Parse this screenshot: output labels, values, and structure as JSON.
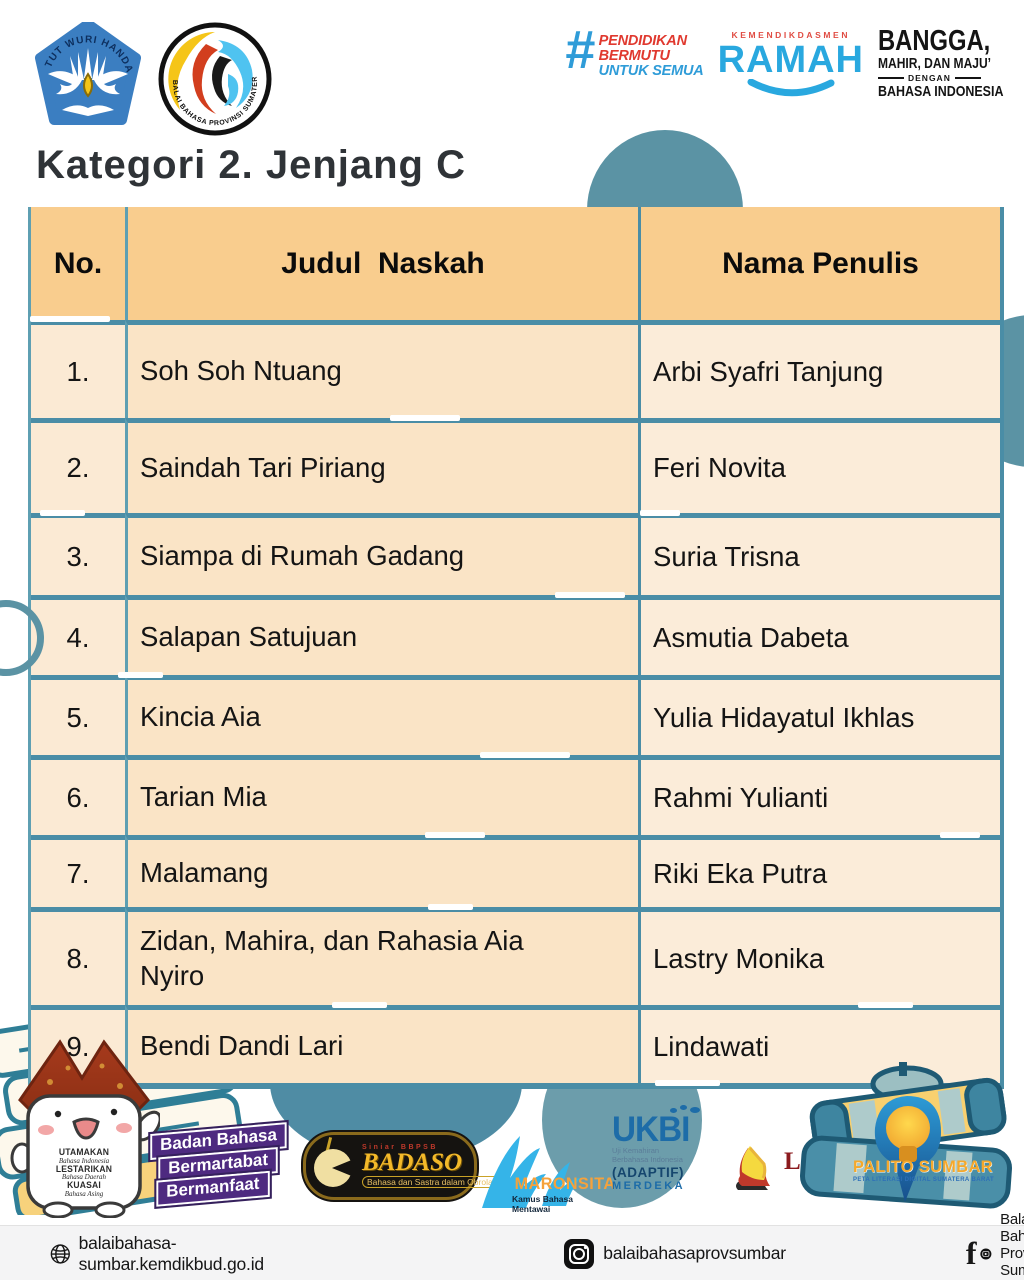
{
  "title": "Kategori 2. Jenjang C",
  "header": {
    "tut_wuri_arc": "TUT WURI HANDAYANI",
    "balai_arc": "BALAI BAHASA PROVINSI SUMATERA BARAT",
    "hashtag": "#",
    "pendidikan": "PENDIDIKAN",
    "bermutu": "BERMUTU",
    "untuk_semua": "UNTUK SEMUA",
    "kemendikdasmen": "KEMENDIKDASMEN",
    "ramah": "RAMAH",
    "bangga": "BANGGA,",
    "mahir": "MAHIR, DAN MAJU’",
    "dengan": "DENGAN",
    "bahasa_indonesia": "BAHASA INDONESIA"
  },
  "table": {
    "columns": {
      "no": "No.",
      "judul": "Judul  Naskah",
      "penulis": "Nama Penulis"
    },
    "rows": [
      {
        "no": "1.",
        "judul": "Soh Soh Ntuang",
        "penulis": "Arbi Syafri Tanjung"
      },
      {
        "no": "2.",
        "judul": "Saindah Tari Piriang",
        "penulis": "Feri Novita"
      },
      {
        "no": "3.",
        "judul": "Siampa di Rumah Gadang",
        "penulis": "Suria Trisna"
      },
      {
        "no": "4.",
        "judul": "Salapan Satujuan",
        "penulis": "Asmutia Dabeta"
      },
      {
        "no": "5.",
        "judul": "Kincia Aia",
        "penulis": "Yulia Hidayatul Ikhlas"
      },
      {
        "no": "6.",
        "judul": "Tarian Mia",
        "penulis": "Rahmi Yulianti"
      },
      {
        "no": "7.",
        "judul": "Malamang",
        "penulis": "Riki Eka Putra"
      },
      {
        "no": "8.",
        "judul": "Zidan, Mahira, dan Rahasia Aia Nyiro",
        "penulis": "Lastry Monika"
      },
      {
        "no": "9.",
        "judul": "Bendi Dandi Lari",
        "penulis": "Lindawati"
      }
    ]
  },
  "mascot": {
    "utamakan": "UTAMAKAN",
    "bahasa_indonesia": "Bahasa Indonesia",
    "lestarikan": "LESTARIKAN",
    "bahasa_daerah": "Bahasa Daerah",
    "kuasai": "KUASAI",
    "bahasa_asing": "Bahasa Asing"
  },
  "partners": {
    "badan_bahasa": {
      "line1": "Badan Bahasa",
      "line2": "Bermartabat",
      "line3": "Bermanfaat"
    },
    "badaso": {
      "siniar": "Siniar BBPSB",
      "name": "BADASO",
      "tagline": "Bahasa dan Sastra dalam Obrolan"
    },
    "maronsita": {
      "name": "MARONSITA",
      "tagline": "Kamus Bahasa Mentawai"
    },
    "ukbi": {
      "name": "UKBI",
      "sub1": "Uji Kemahiran",
      "sub2": "Berbahasa Indonesia",
      "adaptif": "(ADAPTIF)",
      "merdeka": "MERDEKA"
    },
    "limpapeh": {
      "name": "LIMPAPEH",
      "tagline": "Kamus Bahasa Minangkabau"
    },
    "palito": {
      "name": "PALITO SUMBAR",
      "tagline": "PETA LITERASI DIGITAL SUMATERA BARAT"
    }
  },
  "footer": {
    "website": "balaibahasa-sumbar.kemdikbud.go.id",
    "instagram": "balaibahasaprovsumbar",
    "social": "Balai Bahasa Provinsi Sumatera Barat"
  },
  "colors": {
    "table_header": "#F9CD8E",
    "table_row": "#FBE8D0",
    "border_teal": "#4A8DA6",
    "blob_teal": "#5B93A4",
    "accent_red": "#E0392F",
    "accent_blue": "#29A8DF",
    "purple": "#4E2A80",
    "gold": "#F3B929"
  }
}
